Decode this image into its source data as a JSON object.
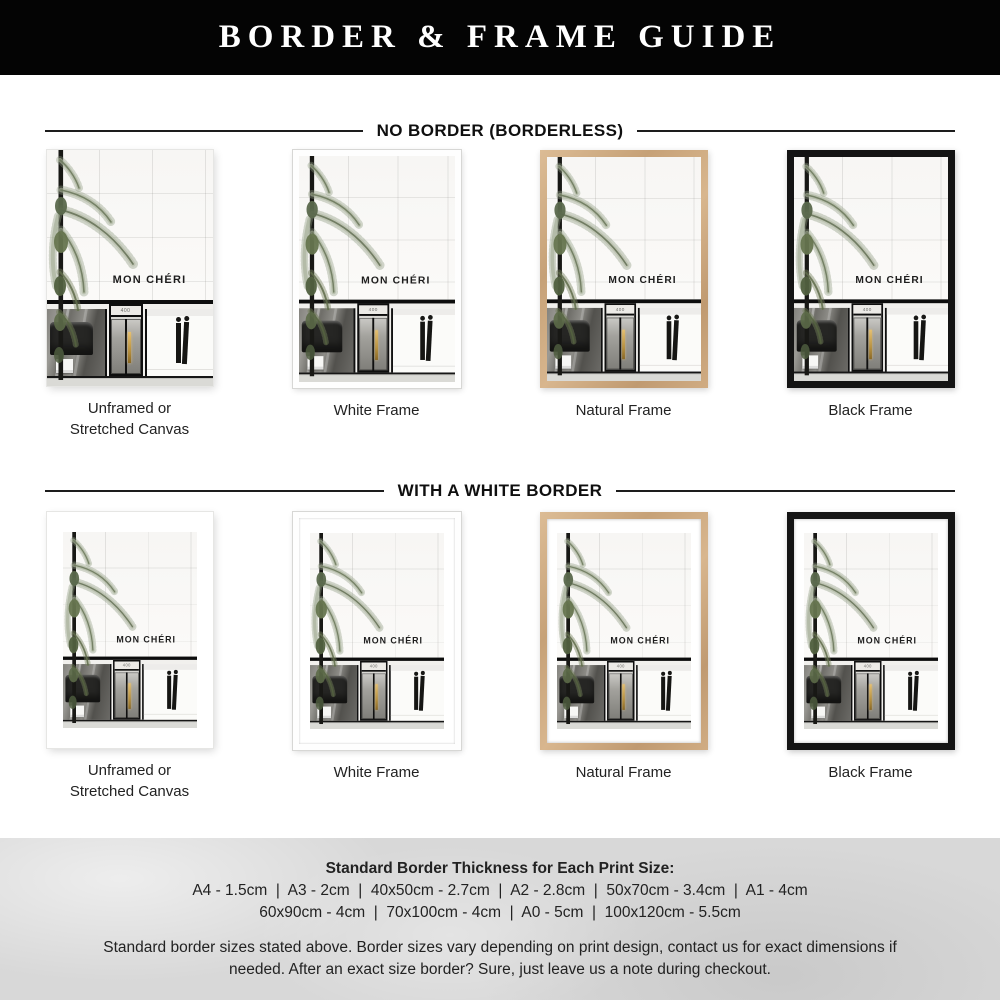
{
  "header": {
    "title": "BORDER & FRAME GUIDE"
  },
  "artwork": {
    "brand": "MON CHÉRI",
    "door_number": "400"
  },
  "sections": [
    {
      "title": "NO BORDER (BORDERLESS)",
      "items": [
        {
          "label": "Unframed or Stretched Canvas",
          "frame": "unframed"
        },
        {
          "label": "White Frame",
          "frame": "white"
        },
        {
          "label": "Natural Frame",
          "frame": "natural"
        },
        {
          "label": "Black Frame",
          "frame": "black"
        }
      ]
    },
    {
      "title": "WITH A WHITE BORDER",
      "items": [
        {
          "label": "Unframed or Stretched Canvas",
          "frame": "unframed"
        },
        {
          "label": "White Frame",
          "frame": "white"
        },
        {
          "label": "Natural Frame",
          "frame": "natural"
        },
        {
          "label": "Black Frame",
          "frame": "black"
        }
      ]
    }
  ],
  "footer": {
    "heading": "Standard Border Thickness for Each Print Size:",
    "sizes_line1": "A4 - 1.5cm  |  A3 - 2cm  |  40x50cm - 2.7cm  |  A2 - 2.8cm  |  50x70cm - 3.4cm  |  A1 - 4cm",
    "sizes_line2": "60x90cm - 4cm  |  70x100cm - 4cm  |  A0 - 5cm  |  100x120cm - 5.5cm",
    "note": "Standard border sizes stated above. Border sizes vary depending on print design, contact us for exact dimensions if needed. After an exact size border? Sure, just leave us a note during checkout."
  },
  "colors": {
    "header_bg": "#040404",
    "header_text": "#ffffff",
    "divider": "#1d1d1d",
    "white_frame": "#fefefe",
    "natural_frame_wood": "#cfa87e",
    "black_frame": "#141414",
    "footer_bg": "#d8d8d8"
  }
}
